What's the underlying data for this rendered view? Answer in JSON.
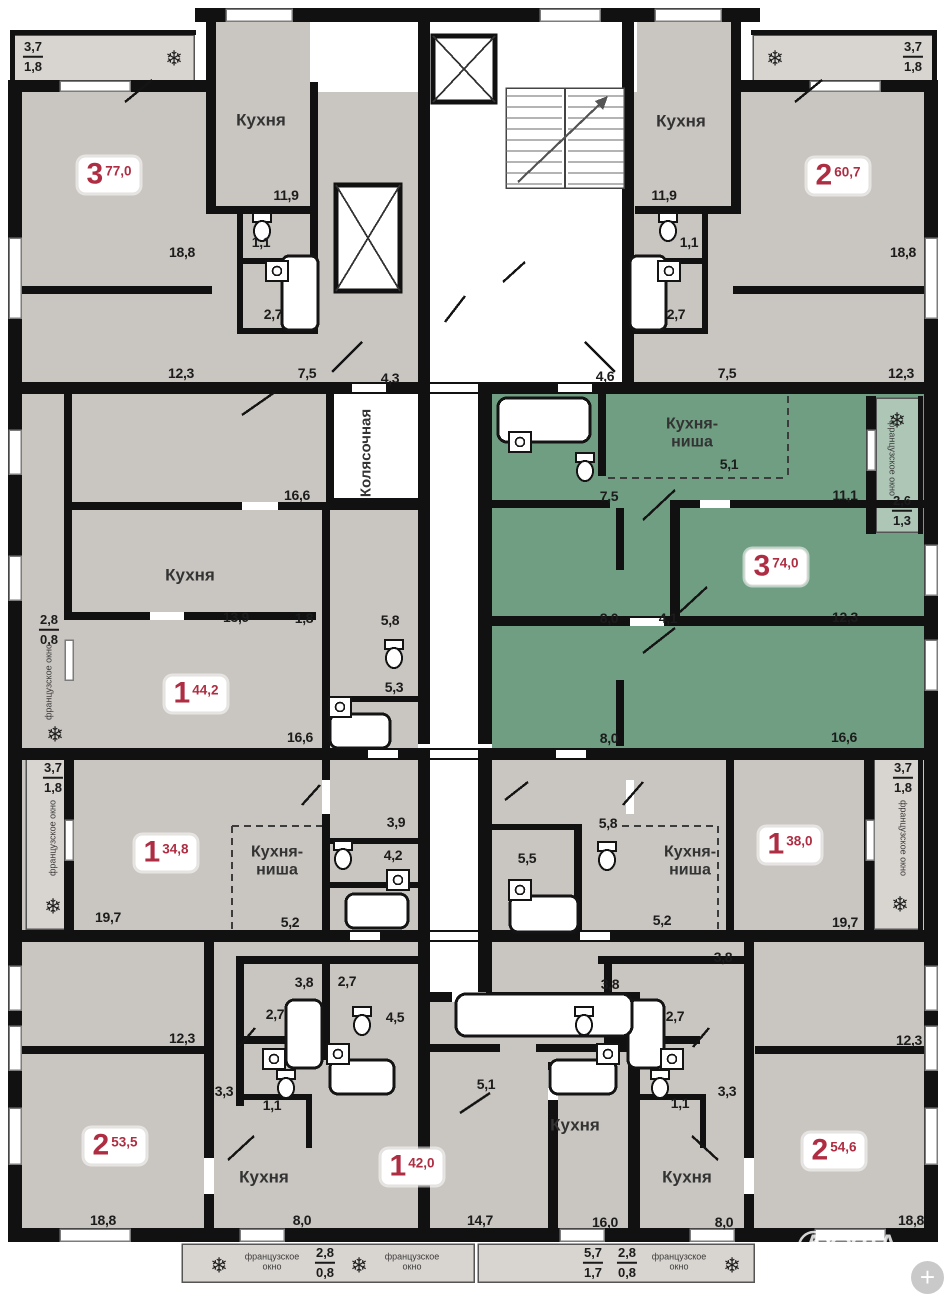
{
  "watermark": {
    "text": "АКУЛА"
  },
  "controls": {
    "zoom_plus": "+"
  },
  "colors": {
    "wall": "#111111",
    "room_gray": "#c9c5c0",
    "balcony_gray": "#d8d4cf",
    "highlight_green": "#6f9e82",
    "balcony_green": "#adc6b6",
    "accent_red": "#ae2d42"
  },
  "apartments": [
    {
      "rooms": "3",
      "area": "77,0"
    },
    {
      "rooms": "2",
      "area": "60,7"
    },
    {
      "rooms": "1",
      "area": "44,2"
    },
    {
      "rooms": "3",
      "area": "74,0",
      "highlighted": true
    },
    {
      "rooms": "1",
      "area": "34,8"
    },
    {
      "rooms": "1",
      "area": "38,0"
    },
    {
      "rooms": "2",
      "area": "53,5"
    },
    {
      "rooms": "1",
      "area": "42,0"
    },
    {
      "rooms": "2",
      "area": "54,6"
    }
  ],
  "labels": [
    {
      "t": "frac",
      "x": 33,
      "y": 57,
      "top": "3,7",
      "bottom": "1,8"
    },
    {
      "t": "snow",
      "x": 174,
      "y": 59,
      "text": "❄",
      "icon": "snowflake"
    },
    {
      "t": "room",
      "x": 261,
      "y": 120,
      "text": "Кухня"
    },
    {
      "t": "badge",
      "x": 109,
      "y": 175,
      "num": "3",
      "area": "77,0",
      "name": "apartment-badge-77"
    },
    {
      "t": "dim",
      "x": 286,
      "y": 195,
      "text": "11,9"
    },
    {
      "t": "dim",
      "x": 261,
      "y": 242,
      "text": "1,1"
    },
    {
      "t": "dim",
      "x": 182,
      "y": 252,
      "text": "18,8"
    },
    {
      "t": "dim",
      "x": 273,
      "y": 314,
      "text": "2,7"
    },
    {
      "t": "dim",
      "x": 181,
      "y": 373,
      "text": "12,3"
    },
    {
      "t": "dim",
      "x": 307,
      "y": 373,
      "text": "7,5"
    },
    {
      "t": "dim",
      "x": 390,
      "y": 378,
      "text": "4,3"
    },
    {
      "t": "frac",
      "x": 913,
      "y": 57,
      "top": "3,7",
      "bottom": "1,8"
    },
    {
      "t": "snow",
      "x": 775,
      "y": 59,
      "text": "❄",
      "icon": "snowflake"
    },
    {
      "t": "room",
      "x": 681,
      "y": 121,
      "text": "Кухня"
    },
    {
      "t": "badge",
      "x": 838,
      "y": 176,
      "num": "2",
      "area": "60,7",
      "name": "apartment-badge-60"
    },
    {
      "t": "dim",
      "x": 664,
      "y": 195,
      "text": "11,9"
    },
    {
      "t": "dim",
      "x": 689,
      "y": 242,
      "text": "1,1"
    },
    {
      "t": "dim",
      "x": 903,
      "y": 252,
      "text": "18,8"
    },
    {
      "t": "dim",
      "x": 676,
      "y": 314,
      "text": "2,7"
    },
    {
      "t": "dim",
      "x": 901,
      "y": 373,
      "text": "12,3"
    },
    {
      "t": "dim",
      "x": 727,
      "y": 373,
      "text": "7,5"
    },
    {
      "t": "dim",
      "x": 605,
      "y": 376,
      "text": "4,6"
    },
    {
      "t": "roomv",
      "x": 366,
      "y": 453,
      "text": "Колясочная"
    },
    {
      "t": "dim",
      "x": 297,
      "y": 495,
      "text": "16,6"
    },
    {
      "t": "room",
      "x": 190,
      "y": 575,
      "text": "Кухня"
    },
    {
      "t": "dim",
      "x": 236,
      "y": 617,
      "text": "13,9"
    },
    {
      "t": "dim",
      "x": 304,
      "y": 618,
      "text": "1,8"
    },
    {
      "t": "dim",
      "x": 390,
      "y": 620,
      "text": "5,8"
    },
    {
      "t": "frac",
      "x": 49,
      "y": 630,
      "top": "2,8",
      "bottom": "0,8"
    },
    {
      "t": "winl",
      "x": 49,
      "y": 682,
      "text": "французское окно"
    },
    {
      "t": "badge",
      "x": 196,
      "y": 694,
      "num": "1",
      "area": "44,2",
      "name": "apartment-badge-44"
    },
    {
      "t": "dim",
      "x": 394,
      "y": 687,
      "text": "5,3"
    },
    {
      "t": "snow",
      "x": 55,
      "y": 735,
      "text": "❄",
      "icon": "snowflake"
    },
    {
      "t": "dim",
      "x": 300,
      "y": 737,
      "text": "16,6"
    },
    {
      "t": "room2",
      "x": 692,
      "y": 434,
      "lines": [
        "Кухня-",
        "ниша"
      ]
    },
    {
      "t": "snow",
      "x": 897,
      "y": 421,
      "text": "❄",
      "icon": "snowflake"
    },
    {
      "t": "dim",
      "x": 729,
      "y": 464,
      "text": "5,1"
    },
    {
      "t": "winr",
      "x": 892,
      "y": 458,
      "text": "французское окно"
    },
    {
      "t": "dim",
      "x": 609,
      "y": 496,
      "text": "7,5"
    },
    {
      "t": "dim",
      "x": 845,
      "y": 495,
      "text": "11,1"
    },
    {
      "t": "frac",
      "x": 902,
      "y": 511,
      "top": "2,6",
      "bottom": "1,3"
    },
    {
      "t": "badge",
      "x": 776,
      "y": 567,
      "num": "3",
      "area": "74,0",
      "name": "apartment-badge-74"
    },
    {
      "t": "dim",
      "x": 609,
      "y": 618,
      "text": "8,0"
    },
    {
      "t": "dim",
      "x": 668,
      "y": 618,
      "text": "4,1"
    },
    {
      "t": "dim",
      "x": 845,
      "y": 617,
      "text": "12,3"
    },
    {
      "t": "dim",
      "x": 609,
      "y": 738,
      "text": "8,0"
    },
    {
      "t": "dim",
      "x": 844,
      "y": 737,
      "text": "16,6"
    },
    {
      "t": "frac",
      "x": 53,
      "y": 778,
      "top": "3,7",
      "bottom": "1,8"
    },
    {
      "t": "winl",
      "x": 53,
      "y": 838,
      "text": "французское окно"
    },
    {
      "t": "snow",
      "x": 53,
      "y": 907,
      "text": "❄",
      "icon": "snowflake"
    },
    {
      "t": "badge",
      "x": 166,
      "y": 853,
      "num": "1",
      "area": "34,8",
      "name": "apartment-badge-34"
    },
    {
      "t": "room2",
      "x": 277,
      "y": 862,
      "lines": [
        "Кухня-",
        "ниша"
      ]
    },
    {
      "t": "dim",
      "x": 396,
      "y": 822,
      "text": "3,9"
    },
    {
      "t": "dim",
      "x": 393,
      "y": 855,
      "text": "4,2"
    },
    {
      "t": "dim",
      "x": 108,
      "y": 917,
      "text": "19,7"
    },
    {
      "t": "dim",
      "x": 290,
      "y": 922,
      "text": "5,2"
    },
    {
      "t": "dim",
      "x": 608,
      "y": 823,
      "text": "5,8"
    },
    {
      "t": "dim",
      "x": 527,
      "y": 858,
      "text": "5,5"
    },
    {
      "t": "room2",
      "x": 690,
      "y": 862,
      "lines": [
        "Кухня-",
        "ниша"
      ]
    },
    {
      "t": "badge",
      "x": 790,
      "y": 845,
      "num": "1",
      "area": "38,0",
      "name": "apartment-badge-38"
    },
    {
      "t": "dim",
      "x": 662,
      "y": 920,
      "text": "5,2"
    },
    {
      "t": "dim",
      "x": 845,
      "y": 922,
      "text": "19,7"
    },
    {
      "t": "frac",
      "x": 903,
      "y": 778,
      "top": "3,7",
      "bottom": "1,8"
    },
    {
      "t": "winr",
      "x": 903,
      "y": 838,
      "text": "французское окно"
    },
    {
      "t": "snow",
      "x": 900,
      "y": 905,
      "text": "❄",
      "icon": "snowflake"
    },
    {
      "t": "dim",
      "x": 723,
      "y": 957,
      "text": "3,8"
    },
    {
      "t": "dim",
      "x": 304,
      "y": 982,
      "text": "3,8"
    },
    {
      "t": "dim",
      "x": 347,
      "y": 981,
      "text": "2,7"
    },
    {
      "t": "dim",
      "x": 610,
      "y": 984,
      "text": "3,8"
    },
    {
      "t": "dim",
      "x": 275,
      "y": 1014,
      "text": "2,7"
    },
    {
      "t": "dim",
      "x": 395,
      "y": 1017,
      "text": "4,5"
    },
    {
      "t": "dim",
      "x": 675,
      "y": 1016,
      "text": "2,7"
    },
    {
      "t": "dim",
      "x": 182,
      "y": 1038,
      "text": "12,3"
    },
    {
      "t": "dim",
      "x": 909,
      "y": 1040,
      "text": "12,3"
    },
    {
      "t": "dim",
      "x": 224,
      "y": 1091,
      "text": "3,3"
    },
    {
      "t": "dim",
      "x": 272,
      "y": 1105,
      "text": "1,1"
    },
    {
      "t": "dim",
      "x": 727,
      "y": 1091,
      "text": "3,3"
    },
    {
      "t": "dim",
      "x": 680,
      "y": 1103,
      "text": "1,1"
    },
    {
      "t": "dim",
      "x": 486,
      "y": 1084,
      "text": "5,1"
    },
    {
      "t": "badge",
      "x": 115,
      "y": 1146,
      "num": "2",
      "area": "53,5",
      "name": "apartment-badge-53"
    },
    {
      "t": "badge",
      "x": 412,
      "y": 1167,
      "num": "1",
      "area": "42,0",
      "name": "apartment-badge-42"
    },
    {
      "t": "badge",
      "x": 834,
      "y": 1151,
      "num": "2",
      "area": "54,6",
      "name": "apartment-badge-54"
    },
    {
      "t": "room",
      "x": 264,
      "y": 1177,
      "text": "Кухня"
    },
    {
      "t": "room",
      "x": 575,
      "y": 1125,
      "text": "Кухня"
    },
    {
      "t": "room",
      "x": 687,
      "y": 1177,
      "text": "Кухня"
    },
    {
      "t": "dim",
      "x": 103,
      "y": 1220,
      "text": "18,8"
    },
    {
      "t": "dim",
      "x": 302,
      "y": 1220,
      "text": "8,0"
    },
    {
      "t": "dim",
      "x": 480,
      "y": 1220,
      "text": "14,7"
    },
    {
      "t": "dim",
      "x": 605,
      "y": 1222,
      "text": "16,0"
    },
    {
      "t": "dim",
      "x": 724,
      "y": 1222,
      "text": "8,0"
    },
    {
      "t": "dim",
      "x": 911,
      "y": 1220,
      "text": "18,8"
    },
    {
      "t": "snow",
      "x": 219,
      "y": 1266,
      "text": "❄",
      "icon": "snowflake"
    },
    {
      "t": "win",
      "x": 272,
      "y": 1262,
      "lines": [
        "французское",
        "окно"
      ]
    },
    {
      "t": "frac",
      "x": 325,
      "y": 1263,
      "top": "2,8",
      "bottom": "0,8"
    },
    {
      "t": "snow",
      "x": 359,
      "y": 1266,
      "text": "❄",
      "icon": "snowflake"
    },
    {
      "t": "win",
      "x": 412,
      "y": 1262,
      "lines": [
        "французское",
        "окно"
      ]
    },
    {
      "t": "frac",
      "x": 593,
      "y": 1263,
      "top": "5,7",
      "bottom": "1,7"
    },
    {
      "t": "frac",
      "x": 627,
      "y": 1263,
      "top": "2,8",
      "bottom": "0,8"
    },
    {
      "t": "win",
      "x": 679,
      "y": 1262,
      "lines": [
        "французское",
        "окно"
      ]
    },
    {
      "t": "snow",
      "x": 732,
      "y": 1266,
      "text": "❄",
      "icon": "snowflake"
    }
  ]
}
